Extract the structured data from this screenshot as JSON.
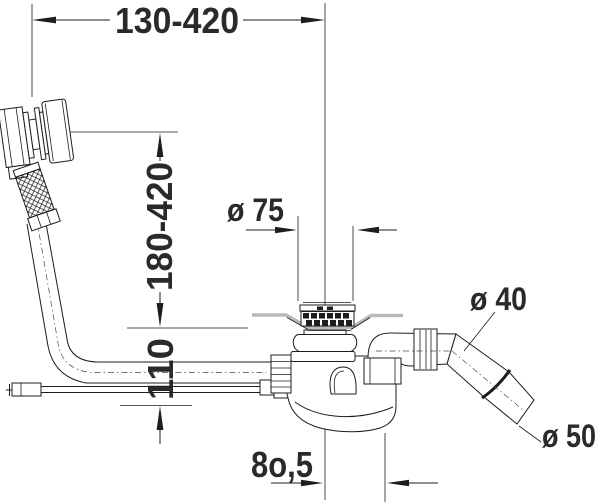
{
  "diagram": {
    "type": "technical-drawing",
    "subject": "bathtub waste, overflow and trap set - side elevation with dimensions",
    "dimensions": {
      "top_span": "130-420",
      "overflow_height_range": "180-420",
      "trap_height": "110",
      "drain_cover_diameter": "ø 75",
      "outlet_pipe_diameter": "ø 40",
      "outlet_end_diameter": "ø 50",
      "outlet_offset": "8o,5"
    },
    "colors": {
      "line": "#1d1d1b",
      "text": "#2a2a2a",
      "tub_surface": "#b9b9b9",
      "background": "#ffffff"
    }
  }
}
